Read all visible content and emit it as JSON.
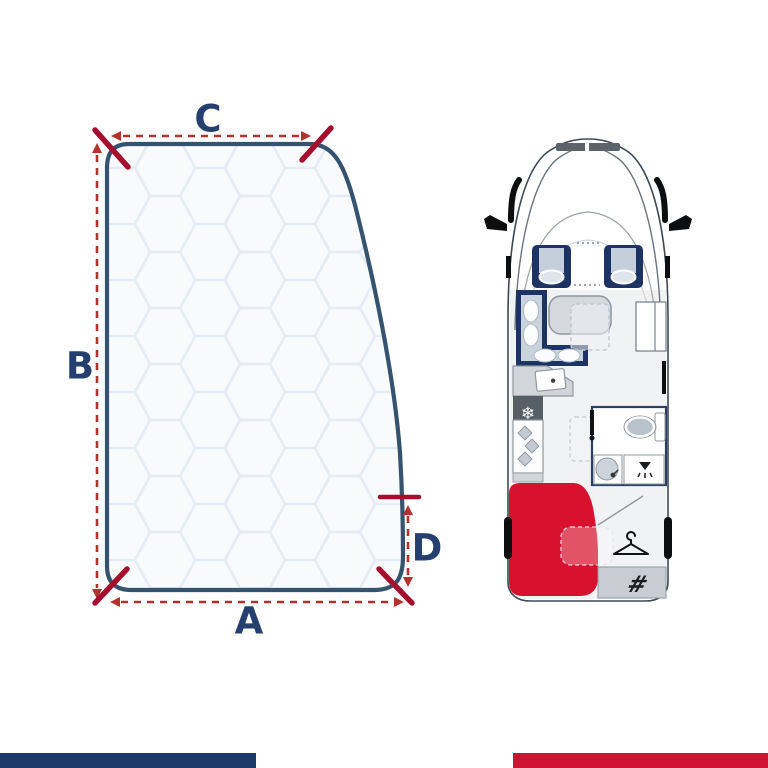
{
  "diagram": {
    "labels": {
      "top_width": "C",
      "left_height": "B",
      "bottom_width": "A",
      "right_height": "D"
    },
    "colors": {
      "mattress_outline": "#35536f",
      "mattress_fill": "#f8fafc",
      "quilt_line": "#e6ecf3",
      "dimension_line_red": "#b2332e",
      "corner_tick_red": "#a50f2e",
      "label_navy": "#25406f"
    }
  },
  "floorplan": {
    "icons": {
      "snowflake_glyph": "❄",
      "garage_glyph": "#"
    },
    "colors": {
      "body_outline": "#3f4956",
      "upholstery_navy": "#1d3363",
      "cushion_gray": "#c5cfdb",
      "table_gray": "#d5d9dd",
      "appliance_dark": "#575e66",
      "bathroom_wall_navy": "#2c3f63",
      "bed_red": "#d8112e",
      "garage_gray": "#c9cdd3",
      "detail_black": "#0c0e10"
    }
  },
  "footer": {
    "left_bar_color": "#1d3a6b",
    "right_bar_color": "#d01234"
  }
}
